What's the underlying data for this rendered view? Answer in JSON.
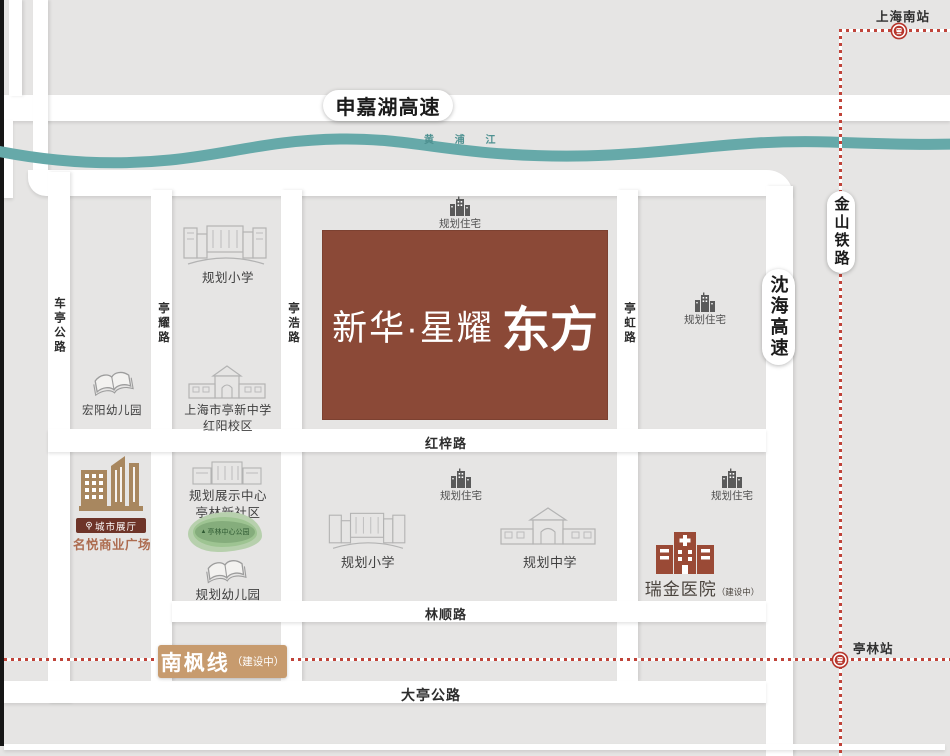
{
  "stations": {
    "top": "上海南站",
    "bottom": "亭林站"
  },
  "highways": {
    "shenjiahu": "申嘉湖高速",
    "jinshan_railway": "金山铁路",
    "shenhai": "沈海高速"
  },
  "river": {
    "name": "黄浦江",
    "display": "黄 浦 江"
  },
  "roads": {
    "cheting": "车亭公路",
    "tingyao": "亭耀路",
    "tinghao": "亭浩路",
    "tinghong": "亭虹路",
    "hongzi": "红梓路",
    "linshun": "林顺路",
    "dating": "大亭公路"
  },
  "metro": {
    "name": "南枫线",
    "status": "（建设中）"
  },
  "project": {
    "prefix": "新华·星耀",
    "suffix": "东方"
  },
  "pois": {
    "planned_residence": "规划住宅",
    "planned_primary": "规划小学",
    "planned_middle": "规划中学",
    "planned_kindergarten": "规划幼儿园",
    "hongyang_kindergarten": "宏阳幼儿园",
    "tingxin_middle_line1": "上海市亭新中学",
    "tingxin_middle_line2": "红阳校区",
    "exhibition_line1": "规划展示中心",
    "exhibition_line2": "亭林新社区",
    "park": "亭林中心公园",
    "city_hall": "城市展厅",
    "mall": "名悦商业广场",
    "hospital": "瑞金医院",
    "hospital_status": "（建设中）"
  },
  "icons": {
    "tree": "▲"
  },
  "colors": {
    "brand_brown": "#8b4937",
    "rail_red": "#c0443a",
    "river_teal": "#66a9a9",
    "metro_badge_tan": "#c79b6e",
    "city_hall_maroon": "#6e3428",
    "mall_brown": "#a8875f",
    "hospital_red": "#9a4a36",
    "block_gray": "#e6e5e4",
    "road_white": "#ffffff"
  }
}
